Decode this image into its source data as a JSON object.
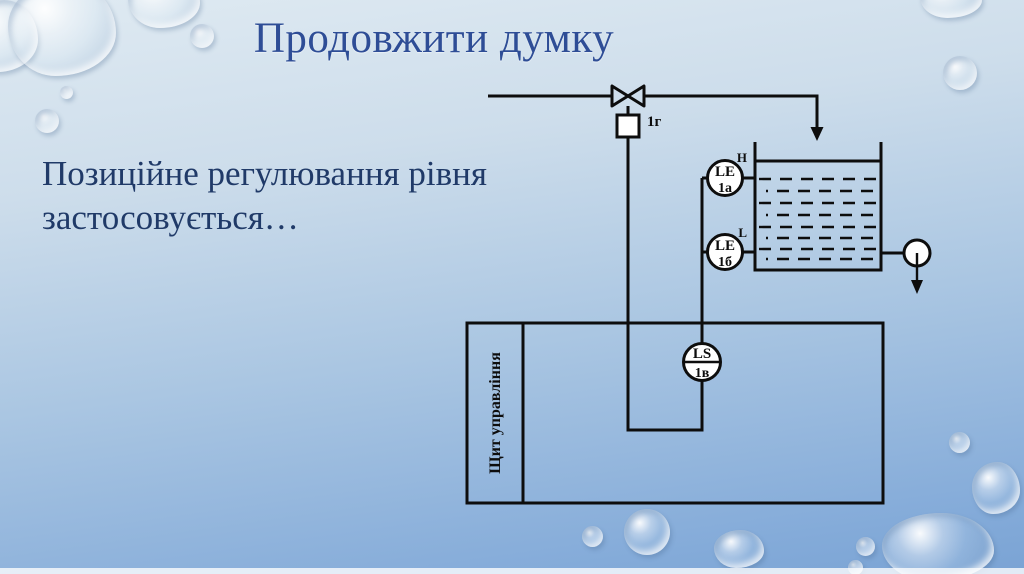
{
  "slide": {
    "title": "Продовжити думку",
    "body_text": "Позиційне регулювання рівня застосовується…"
  },
  "diagram": {
    "valve_tag": "1г",
    "high_level_mark": "H",
    "low_level_mark": "L",
    "sensor_le_1a": {
      "code": "LE",
      "tag": "1а"
    },
    "sensor_le_1b": {
      "code": "LE",
      "tag": "1б"
    },
    "switch_ls_1v": {
      "code": "LS",
      "tag": "1в"
    },
    "control_panel_label": "Щит управління"
  },
  "colors": {
    "title_text": "#2e4d96",
    "body_text": "#203a68",
    "diagram_line": "#0d0d0d",
    "background_top": "#dfeaf2",
    "background_bottom": "#7aa3d4"
  }
}
